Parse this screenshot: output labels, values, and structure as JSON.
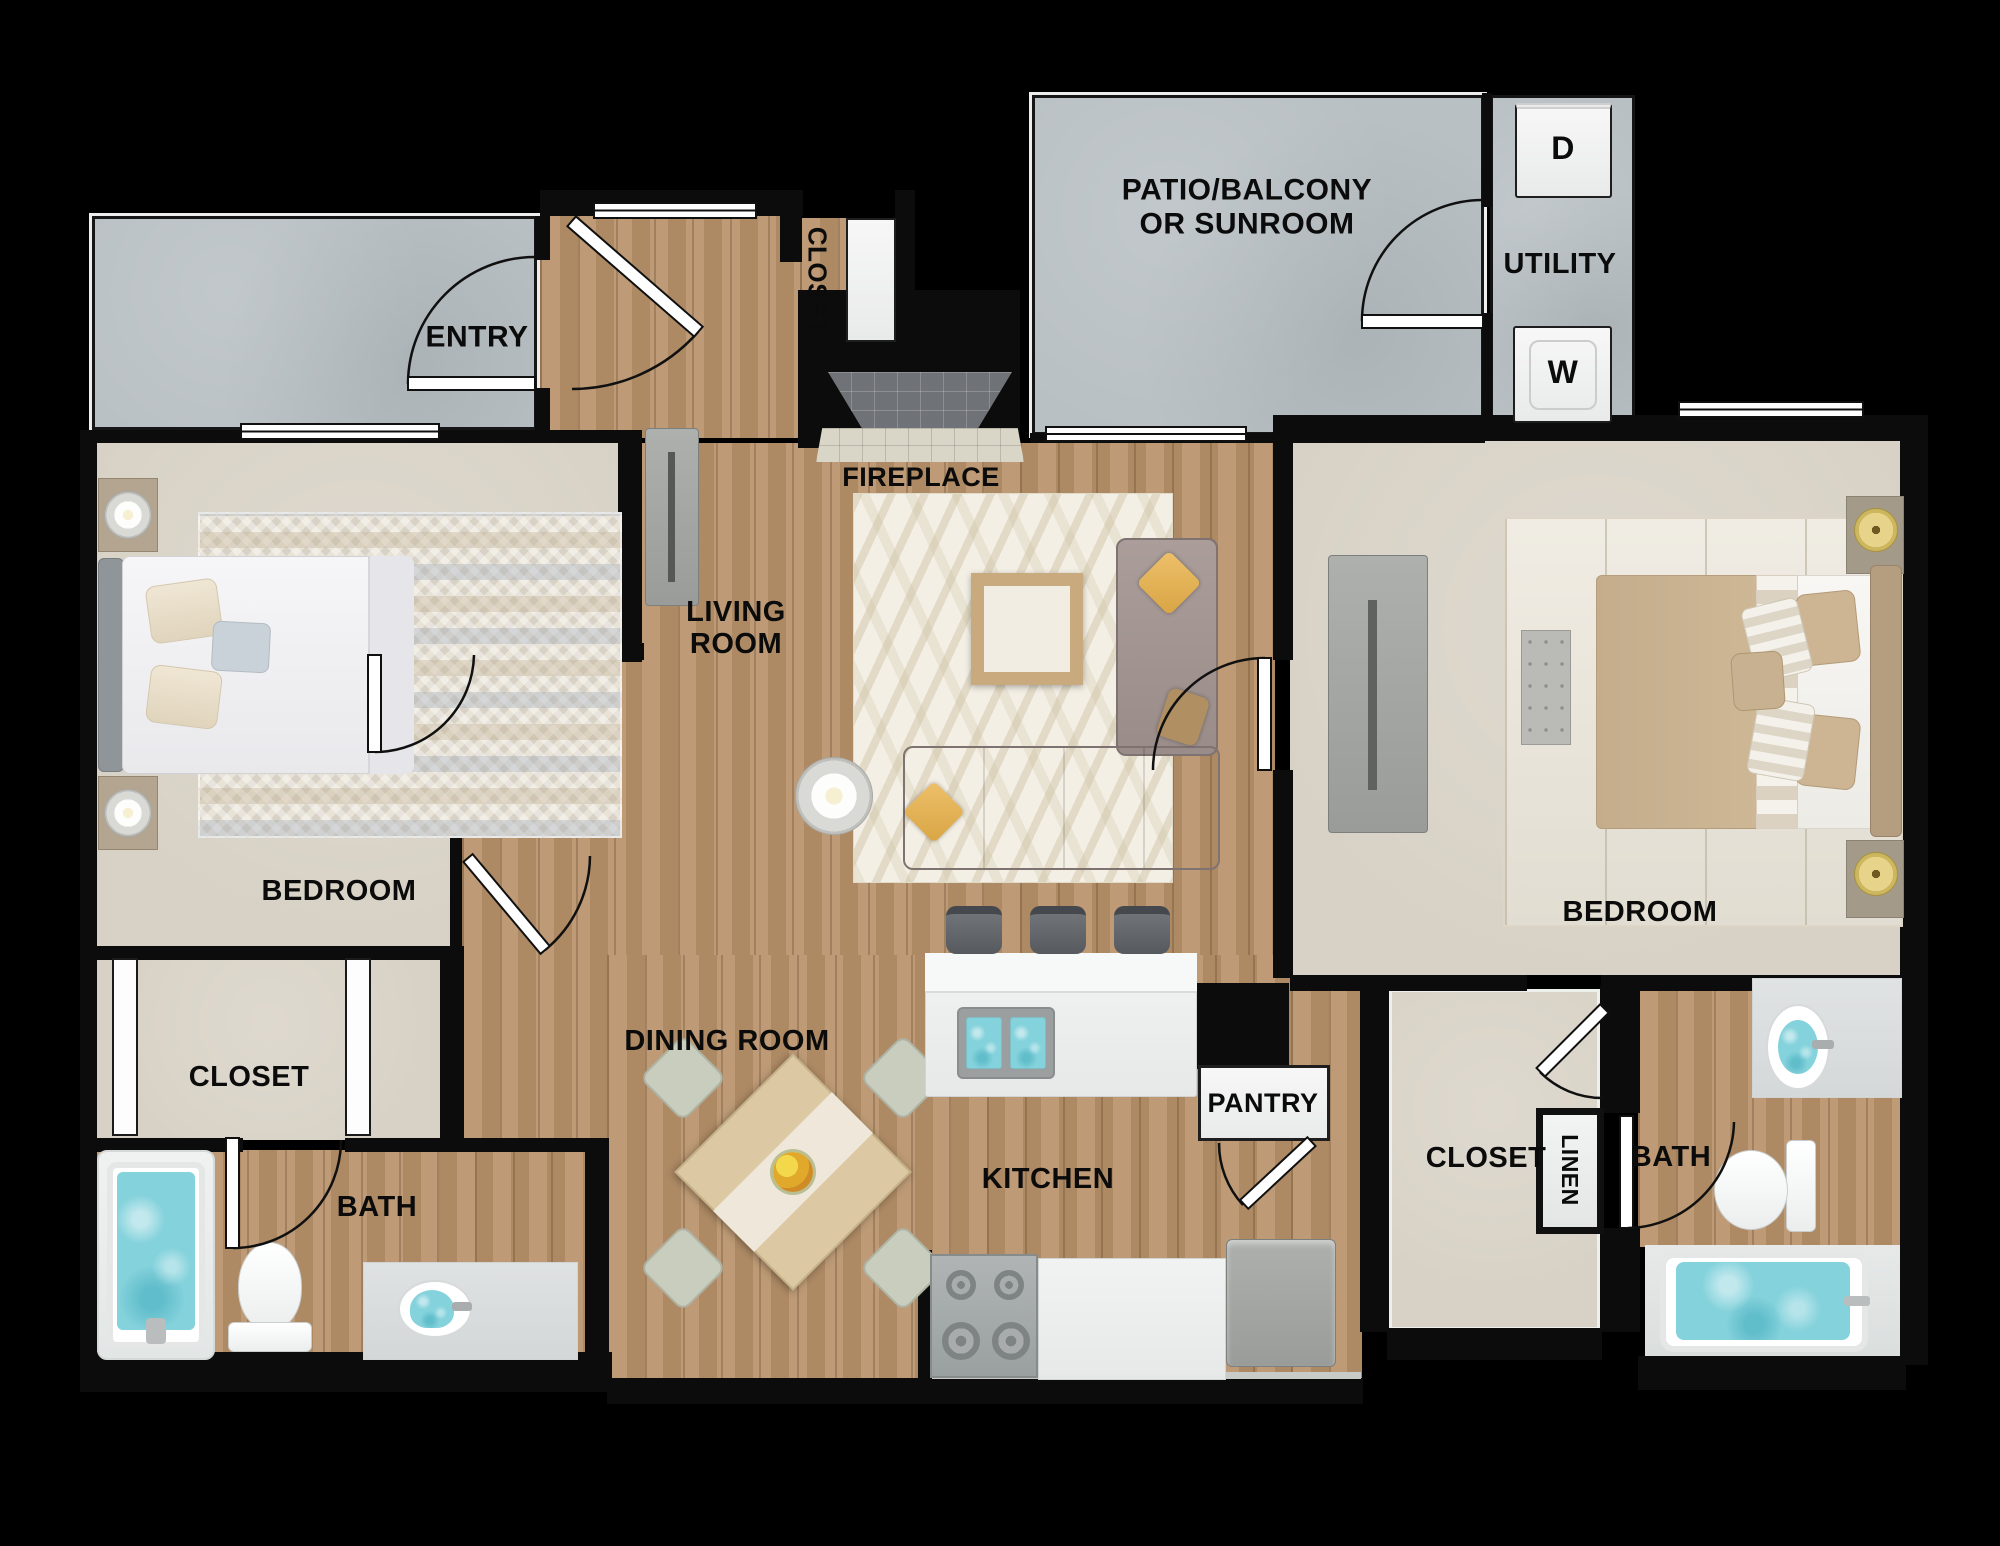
{
  "rooms": {
    "entry": {
      "label": "ENTRY"
    },
    "hall_closet": {
      "label": "CLOSET"
    },
    "patio": {
      "line1": "PATIO/BALCONY",
      "line2": "OR SUNROOM"
    },
    "utility": {
      "label": "UTILITY",
      "dryer": "D",
      "washer": "W"
    },
    "fireplace": {
      "label": "FIREPLACE"
    },
    "living": {
      "line1": "LIVING",
      "line2": "ROOM"
    },
    "bedroom_left": {
      "label": "BEDROOM"
    },
    "closet_left": {
      "label": "CLOSET"
    },
    "bath_left": {
      "label": "BATH"
    },
    "dining": {
      "label": "DINING ROOM"
    },
    "kitchen": {
      "label": "KITCHEN"
    },
    "pantry": {
      "label": "PANTRY"
    },
    "bedroom_right": {
      "label": "BEDROOM"
    },
    "closet_right": {
      "label": "CLOSET"
    },
    "linen": {
      "label": "LINEN"
    },
    "bath_right": {
      "label": "BATH"
    }
  },
  "colors": {
    "background": "#000000",
    "wood_floor": "#b8926a",
    "concrete": "#b9c0c4",
    "carpet": "#d8d2c6",
    "water": "#84d2dc",
    "label_text": "#0b0b0b",
    "accent_pillow": "#e4b458",
    "gold_lamp": "#d6c170"
  }
}
